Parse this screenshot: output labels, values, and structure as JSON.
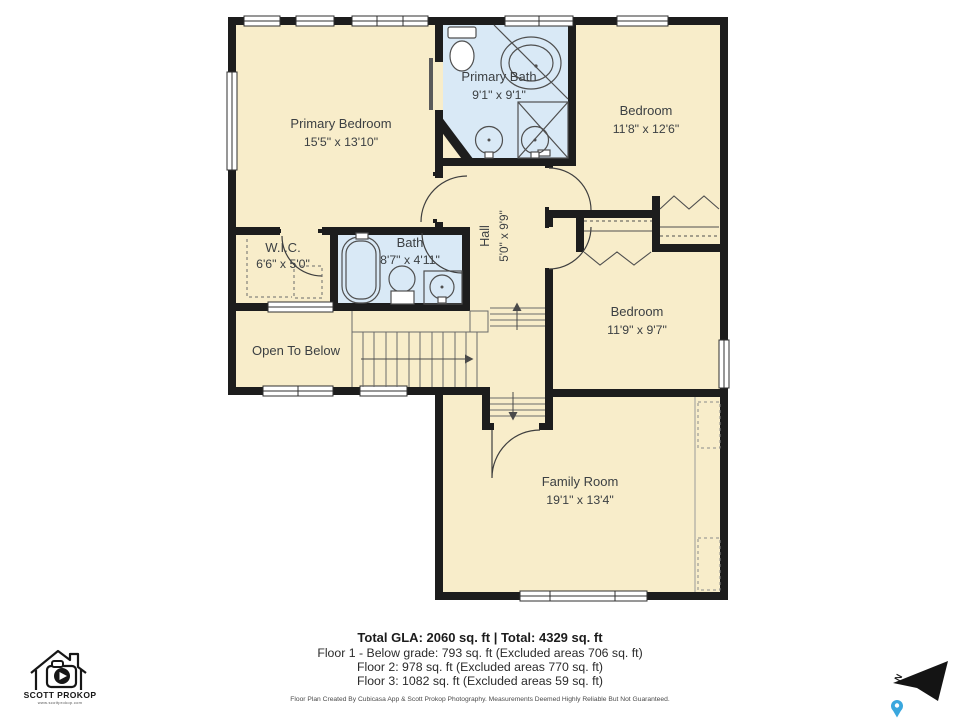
{
  "colors": {
    "wall": "#1d1d1d",
    "room_fill": "#f8edca",
    "bath_fill": "#d9e9f6",
    "label": "#3c4043",
    "pin_blue": "#3aa7de"
  },
  "rooms": [
    {
      "name": "Primary Bedroom",
      "dims": "15'5\" x 13'10\""
    },
    {
      "name": "Primary Bath",
      "dims": "9'1\" x 9'1\""
    },
    {
      "name": "Bedroom",
      "dims": "11'8\" x 12'6\""
    },
    {
      "name": "W.I.C.",
      "dims": "6'6\" x 5'0\""
    },
    {
      "name": "Bath",
      "dims": "8'7\" x 4'11\""
    },
    {
      "name": "Hall",
      "dims": "5'0\" x 9'9\""
    },
    {
      "name": "Open To Below",
      "dims": ""
    },
    {
      "name": "Bedroom",
      "dims": "11'9\" x 9'7\""
    },
    {
      "name": "Family Room",
      "dims": "19'1\" x 13'4\""
    }
  ],
  "footer": {
    "total": "Total GLA: 2060 sq. ft | Total: 4329 sq. ft",
    "floor1": "Floor 1 - Below grade: 793 sq. ft (Excluded areas 706 sq. ft)",
    "floor2": "Floor 2: 978 sq. ft (Excluded areas 770 sq. ft)",
    "floor3": "Floor 3: 1082 sq. ft (Excluded areas 59 sq. ft)",
    "disclaimer": "Floor Plan Created By Cubicasa App & Scott Prokop Photography. Measurements Deemed Highly Reliable But Not Guaranteed."
  },
  "branding": {
    "name": "SCOTT PROKOP",
    "url": "www.scottprokop.com"
  },
  "compass": {
    "north": "N"
  }
}
